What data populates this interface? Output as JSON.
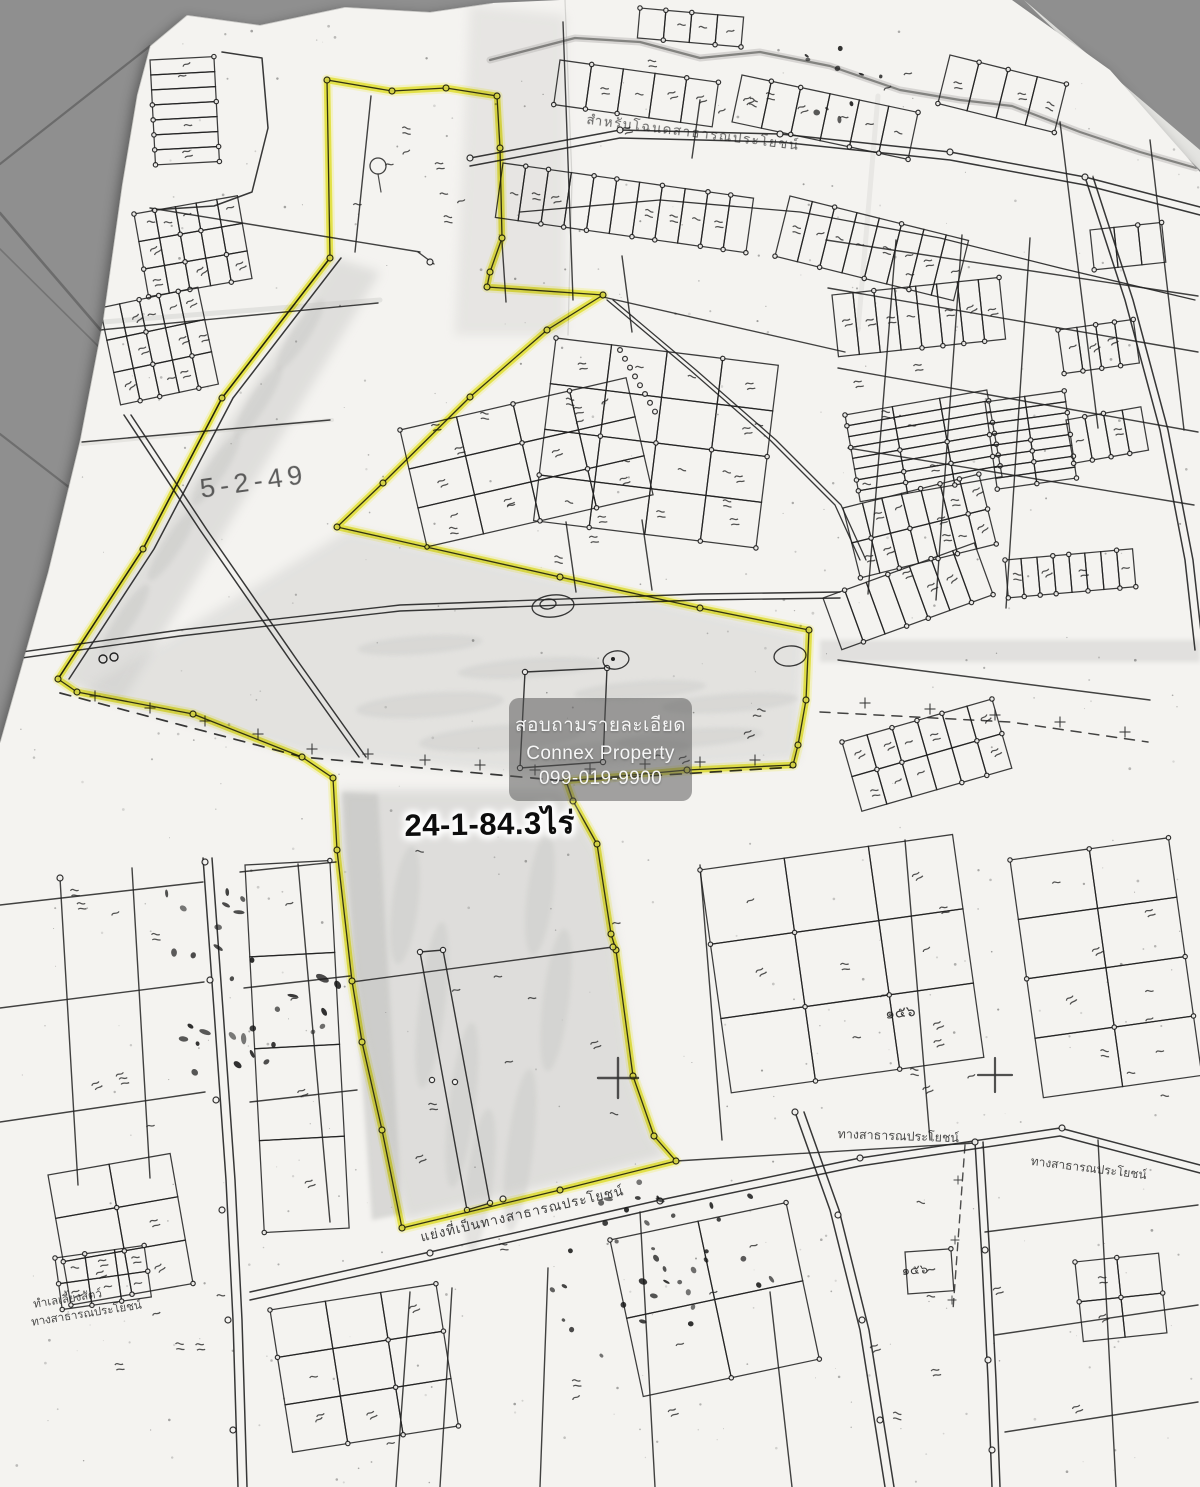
{
  "watermark": {
    "line1": "สอบถามรายละเอียด",
    "line2": "Connex Property",
    "line3": "099-019-9900"
  },
  "labels": {
    "area_rai": "24-1-84.3ไร่",
    "survey_note": "5-2-49",
    "road_top": "สำหรับโฉนดสาธารณประโยชน์",
    "road_public_right": "ทางสาธารณประโยชน์",
    "road_public_far_right": "ทางสาธารณประโยชน์",
    "road_bottom": "แย่งที่เป็นทางสาธารณประโยชน์",
    "pasture_line1": "ทำเลเลี้ยงสัตว์",
    "pasture_line2": "ทางสาธารณประโยชน์",
    "parcel_numeral": "๑๕๖"
  },
  "colors": {
    "background": "#8f8f8f",
    "paper": "#f4f3f0",
    "paper_under": "#e9e9e6",
    "ink": "#222222",
    "highlight": "#e4e332",
    "highlight_soft": "#f0ef8a",
    "wash": "#c6c6c4",
    "watermark_bg": "rgba(85,85,85,0.52)",
    "watermark_text": "#f6f6f6"
  }
}
